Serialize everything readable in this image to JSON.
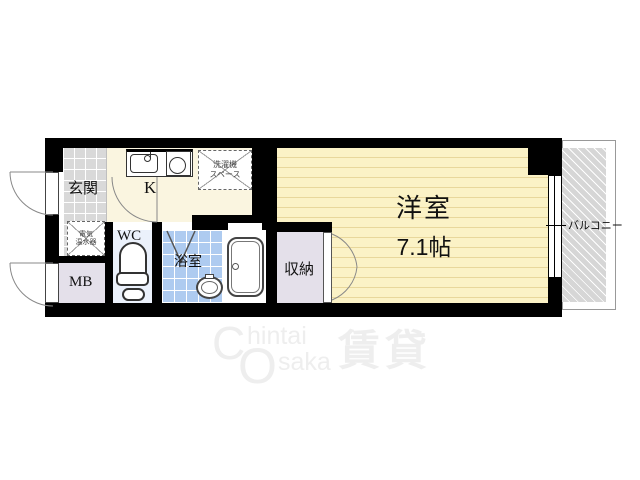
{
  "floorplan": {
    "labels": {
      "genkan": "玄関",
      "kitchen": "K",
      "wc": "WC",
      "bath": "浴室",
      "storage": "収納",
      "meter_box": "MB",
      "main_room": "洋室",
      "main_room_size": "7.1帖",
      "balcony": "バルコニー"
    },
    "annotations": {
      "washer_line1": "洗濯機",
      "washer_line2": "スペース",
      "heater_line1": "電気",
      "heater_line2": "温水器"
    },
    "colors": {
      "wall": "#000000",
      "main_room_bg": "#FBF2C6",
      "main_room_lines": "#E8D79B",
      "kitchen_bg": "#FAF5E0",
      "genkan_tile": "#D9D9D9",
      "wc_bg": "#EBF1FB",
      "bath_tile": "#AECBF0",
      "storage_bg": "#E4E0EA",
      "balcony": "#D6D6D6",
      "watermark": "#EEEEEE"
    }
  },
  "watermark": {
    "c": "C",
    "hintai": "hintai",
    "o": "O",
    "saka": "saka",
    "kanji": "賃貸"
  }
}
